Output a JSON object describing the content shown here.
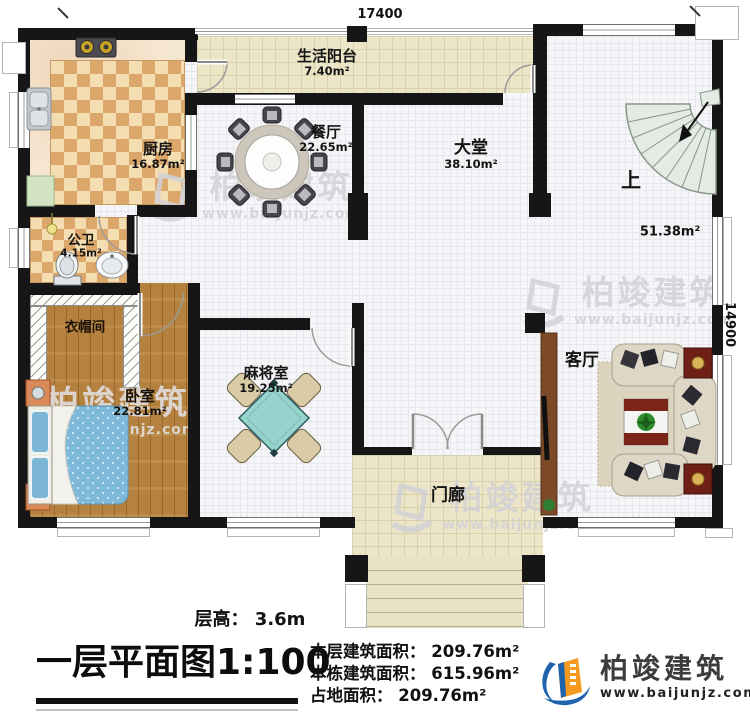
{
  "plan": {
    "dimensions": {
      "width_mm": "17400",
      "height_mm": "14900"
    },
    "rooms": {
      "balcony": {
        "name": "生活阳台",
        "area": "7.40m²"
      },
      "kitchen": {
        "name": "厨房",
        "area": "16.87m²"
      },
      "dining": {
        "name": "餐厅",
        "area": "22.65m²"
      },
      "hall": {
        "name": "大堂",
        "area": "38.10m²"
      },
      "stairhall": {
        "up_label": "上",
        "area": "51.38m²"
      },
      "bathroom": {
        "name": "公卫",
        "area": "4.15m²"
      },
      "cloakroom": {
        "name": "衣帽间"
      },
      "bedroom": {
        "name": "卧室",
        "area": "22.81m²"
      },
      "mahjong": {
        "name": "麻将室",
        "area": "19.25m²"
      },
      "living": {
        "name": "客厅"
      },
      "porch": {
        "name": "门廊"
      }
    }
  },
  "title_block": {
    "floor_height": "层高： 3.6m",
    "title": "一层平面图1:100",
    "floor_area": "本层建筑面积： 209.76m²",
    "total_area": "本栋建筑面积： 615.96m²",
    "footprint": "占地面积： 209.76m²"
  },
  "brand": {
    "name": "柏竣建筑",
    "url": "www.baijunjz.com"
  },
  "watermark": {
    "name": "柏竣建筑",
    "url": "www.baijunjz.com"
  }
}
